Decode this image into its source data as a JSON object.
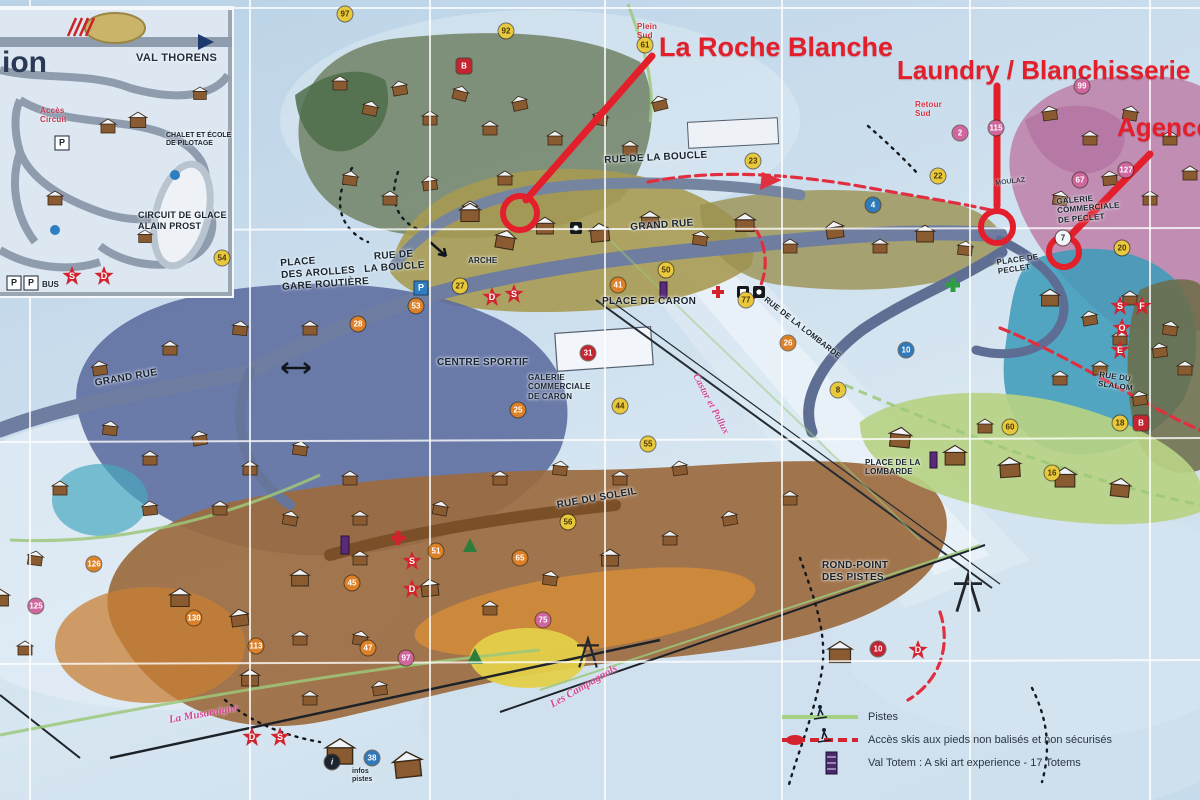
{
  "annotations": {
    "roche_blanche": "La Roche Blanche",
    "laundry": "Laundry / Blanchisserie",
    "agence": "Agence",
    "accent_color": "#e31f2b"
  },
  "inset": {
    "partial_title": "ion",
    "resort_name": "VAL THORENS",
    "acces_circuit": "Accès\nCircuit",
    "chalet_ecole": "CHALET ET ÉCOLE\nDE PILOTAGE",
    "circuit_glace": "CIRCUIT DE GLACE\nALAIN PROST",
    "bus": "BUS",
    "p1": "P",
    "p2": "P",
    "p3": "P"
  },
  "streets": {
    "rue_boucle_top": "RUE DE LA BOUCLE",
    "grand_rue_center": "GRAND RUE",
    "rue_boucle_left": "RUE DE\nLA BOUCLE",
    "arche": "ARCHE",
    "place_arolles": "PLACE\nDES AROLLES\nGARE ROUTIÈRE",
    "place_caron": "PLACE DE CARON",
    "centre_sportif": "CENTRE SPORTIF",
    "galerie_caron": "GALERIE\nCOMMERCIALE\nDE CARON",
    "rue_soleil": "RUE DU SOLEIL",
    "rue_lombarde": "RUE DE LA LOMBARDE",
    "place_lombarde": "PLACE DE LA\nLOMBARDE",
    "place_peclet": "PLACE DE\nPECLET",
    "galerie_peclet": "GALERIE\nCOMMERCIALE\nDE PECLET",
    "rue_slalom": "RUE DU\nSLALOM",
    "rond_point": "ROND-POINT\nDES PISTES",
    "grand_rue_left": "GRAND RUE",
    "moulaz": "MOULAZ"
  },
  "runs": {
    "plein_sud": "Plein\nSud",
    "retour_sud": "Retour\nSud",
    "musaraigne": "La Musaraigne",
    "campagnols": "Les Campagnols",
    "castor_pollux": "Castor et Pollux"
  },
  "legend": {
    "pistes": "Pistes",
    "acces_skis": "Accès skis aux pieds non balisés et non sécurisés",
    "val_totem": "Val Totem : A ski art experience - 17 Totems"
  },
  "infos_pistes": "infos\npistes",
  "badges": [
    {
      "v": "97",
      "x": 345,
      "y": 14,
      "c": "y"
    },
    {
      "v": "92",
      "x": 506,
      "y": 31,
      "c": "y"
    },
    {
      "v": "61",
      "x": 645,
      "y": 45,
      "c": "y"
    },
    {
      "v": "B",
      "x": 464,
      "y": 66,
      "c": "r"
    },
    {
      "v": "115",
      "x": 996,
      "y": 128,
      "c": "p"
    },
    {
      "v": "99",
      "x": 1082,
      "y": 86,
      "c": "p"
    },
    {
      "v": "2",
      "x": 960,
      "y": 133,
      "c": "p"
    },
    {
      "v": "127",
      "x": 1126,
      "y": 170,
      "c": "p"
    },
    {
      "v": "67",
      "x": 1080,
      "y": 180,
      "c": "p"
    },
    {
      "v": "23",
      "x": 753,
      "y": 161,
      "c": "y"
    },
    {
      "v": "22",
      "x": 938,
      "y": 176,
      "c": "y"
    },
    {
      "v": "4",
      "x": 873,
      "y": 205,
      "c": "b"
    },
    {
      "v": "7",
      "x": 1063,
      "y": 238,
      "c": "w"
    },
    {
      "v": "20",
      "x": 1122,
      "y": 248,
      "c": "y"
    },
    {
      "v": "54",
      "x": 222,
      "y": 258,
      "c": "y"
    },
    {
      "v": "27",
      "x": 460,
      "y": 286,
      "c": "y"
    },
    {
      "v": "53",
      "x": 416,
      "y": 306,
      "c": "o"
    },
    {
      "v": "28",
      "x": 358,
      "y": 324,
      "c": "o"
    },
    {
      "v": "50",
      "x": 666,
      "y": 270,
      "c": "y"
    },
    {
      "v": "41",
      "x": 618,
      "y": 285,
      "c": "o"
    },
    {
      "v": "77",
      "x": 746,
      "y": 300,
      "c": "y"
    },
    {
      "v": "31",
      "x": 588,
      "y": 353,
      "c": "rc"
    },
    {
      "v": "25",
      "x": 518,
      "y": 410,
      "c": "o"
    },
    {
      "v": "44",
      "x": 620,
      "y": 406,
      "c": "y"
    },
    {
      "v": "55",
      "x": 648,
      "y": 444,
      "c": "y"
    },
    {
      "v": "10",
      "x": 906,
      "y": 350,
      "c": "b"
    },
    {
      "v": "26",
      "x": 788,
      "y": 343,
      "c": "o"
    },
    {
      "v": "8",
      "x": 838,
      "y": 390,
      "c": "y"
    },
    {
      "v": "60",
      "x": 1010,
      "y": 427,
      "c": "y"
    },
    {
      "v": "18",
      "x": 1120,
      "y": 423,
      "c": "y"
    },
    {
      "v": "B",
      "x": 1141,
      "y": 423,
      "c": "r"
    },
    {
      "v": "16",
      "x": 1052,
      "y": 473,
      "c": "y"
    },
    {
      "v": "56",
      "x": 568,
      "y": 522,
      "c": "y"
    },
    {
      "v": "51",
      "x": 436,
      "y": 551,
      "c": "o"
    },
    {
      "v": "65",
      "x": 520,
      "y": 558,
      "c": "o"
    },
    {
      "v": "45",
      "x": 352,
      "y": 583,
      "c": "o"
    },
    {
      "v": "47",
      "x": 368,
      "y": 648,
      "c": "o"
    },
    {
      "v": "75",
      "x": 543,
      "y": 620,
      "c": "p"
    },
    {
      "v": "97",
      "x": 406,
      "y": 658,
      "c": "p"
    },
    {
      "v": "125",
      "x": 36,
      "y": 606,
      "c": "p"
    },
    {
      "v": "126",
      "x": 94,
      "y": 564,
      "c": "o"
    },
    {
      "v": "130",
      "x": 194,
      "y": 618,
      "c": "o"
    },
    {
      "v": "113",
      "x": 256,
      "y": 646,
      "c": "o"
    },
    {
      "v": "10",
      "x": 878,
      "y": 649,
      "c": "rc"
    },
    {
      "v": "38",
      "x": 372,
      "y": 758,
      "c": "b"
    },
    {
      "v": "i",
      "x": 332,
      "y": 762,
      "c": "k"
    }
  ],
  "star_marks": [
    {
      "v": "S",
      "x": 72,
      "y": 276
    },
    {
      "v": "D",
      "x": 104,
      "y": 276
    },
    {
      "v": "D",
      "x": 492,
      "y": 297
    },
    {
      "v": "S",
      "x": 514,
      "y": 294
    },
    {
      "v": "S",
      "x": 412,
      "y": 561
    },
    {
      "v": "D",
      "x": 412,
      "y": 589
    },
    {
      "v": "S",
      "x": 1120,
      "y": 306
    },
    {
      "v": "F",
      "x": 1142,
      "y": 306
    },
    {
      "v": "O",
      "x": 1122,
      "y": 328
    },
    {
      "v": "E",
      "x": 1120,
      "y": 350
    },
    {
      "v": "D",
      "x": 918,
      "y": 650
    },
    {
      "v": "D",
      "x": 252,
      "y": 737
    },
    {
      "v": "S",
      "x": 280,
      "y": 737
    }
  ]
}
